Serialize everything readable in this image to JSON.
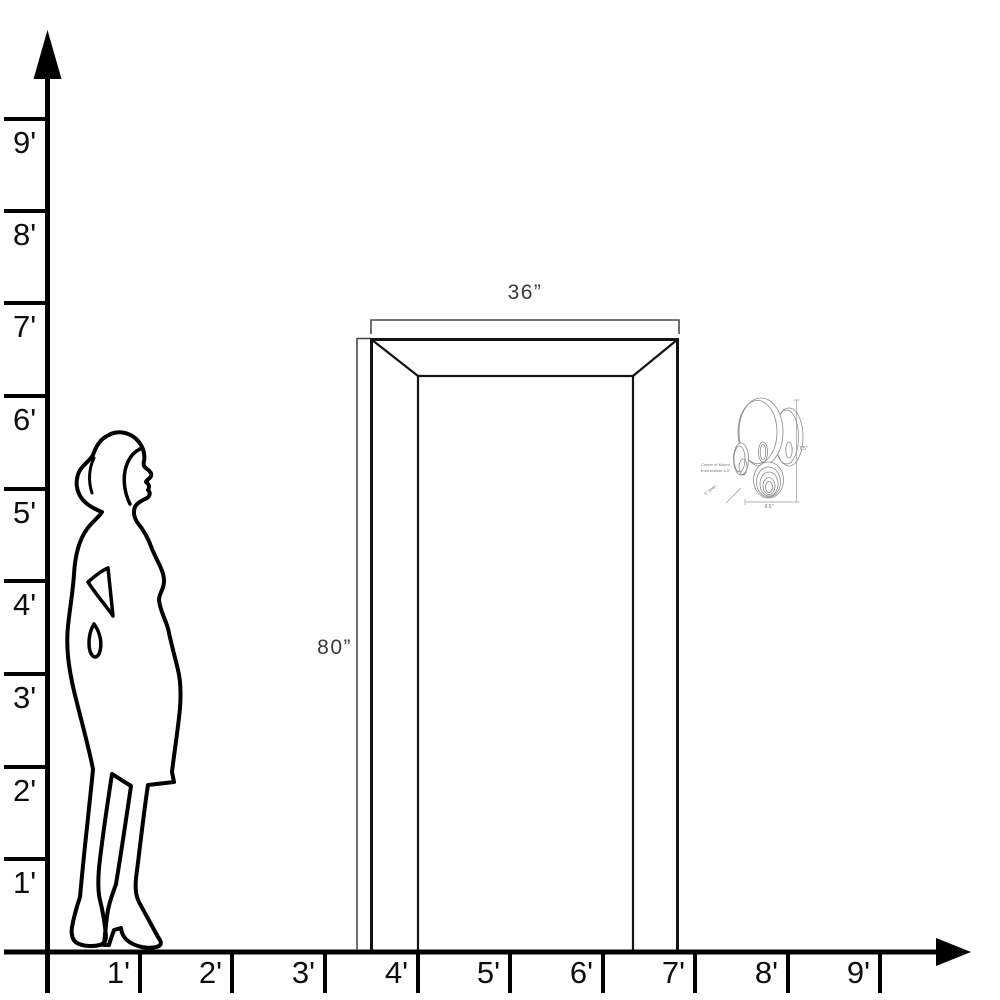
{
  "diagram": {
    "type": "door-size-scale-diagram",
    "y_axis_labels": [
      "9'",
      "8'",
      "7'",
      "6'",
      "5'",
      "4'",
      "3'",
      "2'",
      "1'"
    ],
    "x_axis_labels": [
      "1'",
      "2'",
      "3'",
      "4'",
      "5'",
      "6'",
      "7'",
      "8'",
      "9'"
    ],
    "door": {
      "width_label": "36”",
      "height_label": "80”"
    },
    "sconce": {
      "mount_note_line1": "Center of Mount",
      "mount_note_line2": "from bottom 6.5\"",
      "depth_label": "5\" deep",
      "width_label": "8.5\"",
      "height_label": "7.5\""
    },
    "colors": {
      "axis_line": "#000000",
      "door_line": "#141414",
      "dimension_line": "#4a4a4a",
      "sconce_line": "#8a8a8a"
    }
  }
}
